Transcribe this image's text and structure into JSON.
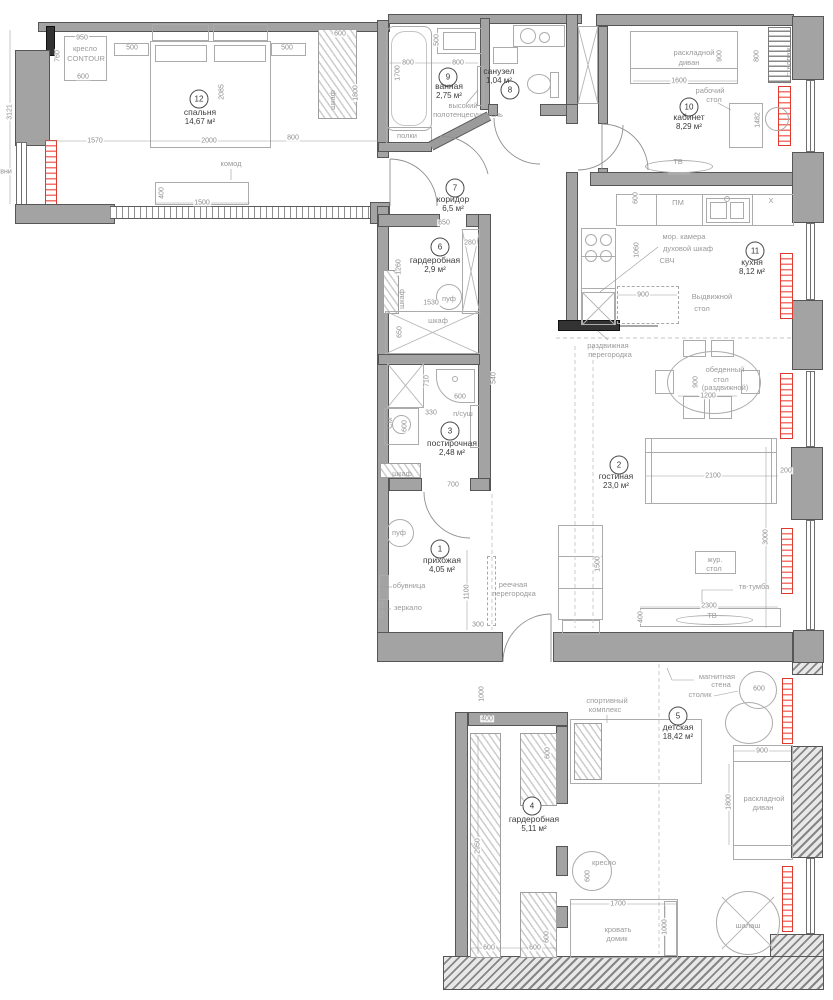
{
  "colors": {
    "wall": "#a3a3a3",
    "wall_dark": "#3f3f3f",
    "radiator": "#e03a2f",
    "dim_text": "#8e8e8e",
    "furniture_text": "#9a9a9a",
    "room_text": "#3c3c3c"
  },
  "rooms": [
    {
      "num": "1",
      "name": "прихожая",
      "area": "4,05 м²",
      "cx": 440,
      "cy": 549,
      "tx": 442,
      "ty": 565
    },
    {
      "num": "2",
      "name": "гостиная",
      "area": "23,0 м²",
      "cx": 619,
      "cy": 465,
      "tx": 616,
      "ty": 481
    },
    {
      "num": "3",
      "name": "постирочная",
      "area": "2,48 м²",
      "cx": 450,
      "cy": 431,
      "tx": 452,
      "ty": 448
    },
    {
      "num": "4",
      "name": "гардеробная",
      "area": "5,11 м²",
      "cx": 532,
      "cy": 806,
      "tx": 534,
      "ty": 824
    },
    {
      "num": "5",
      "name": "детская",
      "area": "18,42 м²",
      "cx": 678,
      "cy": 716,
      "tx": 678,
      "ty": 732
    },
    {
      "num": "6",
      "name": "гардеробная",
      "area": "2,9 м²",
      "cx": 440,
      "cy": 247,
      "tx": 435,
      "ty": 265
    },
    {
      "num": "7",
      "name": "коридор",
      "area": "6,5 м²",
      "cx": 455,
      "cy": 188,
      "tx": 453,
      "ty": 204
    },
    {
      "num": "8",
      "name": "санузел",
      "area": "1,04 м²",
      "cx": 510,
      "cy": 90,
      "tx": 499,
      "ty": 76
    },
    {
      "num": "9",
      "name": "ванная",
      "area": "2,75 м²",
      "cx": 448,
      "cy": 77,
      "tx": 449,
      "ty": 91
    },
    {
      "num": "10",
      "name": "кабинет",
      "area": "8,29 м²",
      "cx": 689,
      "cy": 107,
      "tx": 689,
      "ty": 122
    },
    {
      "num": "11",
      "name": "кухня",
      "area": "8,12 м²",
      "cx": 755,
      "cy": 251,
      "tx": 752,
      "ty": 267
    },
    {
      "num": "12",
      "name": "спальня",
      "area": "14,67 м²",
      "cx": 199,
      "cy": 99,
      "tx": 200,
      "ty": 117
    }
  ],
  "labels": [
    {
      "t": "950",
      "x": 82,
      "y": 38,
      "v": 0,
      "k": "d"
    },
    {
      "t": "500",
      "x": 132,
      "y": 48,
      "v": 0,
      "k": "d"
    },
    {
      "t": "500",
      "x": 287,
      "y": 48,
      "v": 0,
      "k": "d"
    },
    {
      "t": "600",
      "x": 340,
      "y": 34,
      "v": 0,
      "k": "d"
    },
    {
      "t": "760",
      "x": 58,
      "y": 56,
      "v": 1,
      "k": "d"
    },
    {
      "t": "кресло",
      "x": 85,
      "y": 49,
      "v": 0,
      "k": "f"
    },
    {
      "t": "CONTOUR",
      "x": 86,
      "y": 59,
      "v": 0,
      "k": "f"
    },
    {
      "t": "600",
      "x": 83,
      "y": 77,
      "v": 0,
      "k": "d"
    },
    {
      "t": "2085",
      "x": 222,
      "y": 92,
      "v": 1,
      "k": "d"
    },
    {
      "t": "1800",
      "x": 356,
      "y": 93,
      "v": 1,
      "k": "d"
    },
    {
      "t": "шкаф",
      "x": 333,
      "y": 100,
      "v": 1,
      "k": "f"
    },
    {
      "t": "1570",
      "x": 95,
      "y": 141,
      "v": 0,
      "k": "d"
    },
    {
      "t": "2000",
      "x": 209,
      "y": 141,
      "v": 0,
      "k": "d"
    },
    {
      "t": "800",
      "x": 293,
      "y": 138,
      "v": 0,
      "k": "d"
    },
    {
      "t": "комод",
      "x": 231,
      "y": 164,
      "v": 0,
      "k": "f"
    },
    {
      "t": "400",
      "x": 162,
      "y": 193,
      "v": 1,
      "k": "d"
    },
    {
      "t": "1500",
      "x": 202,
      "y": 203,
      "v": 0,
      "k": "d"
    },
    {
      "t": "3121",
      "x": 10,
      "y": 112,
      "v": 1,
      "k": "d"
    },
    {
      "t": "вни",
      "x": 6,
      "y": 172,
      "v": 0,
      "k": "d"
    },
    {
      "t": "500",
      "x": 437,
      "y": 40,
      "v": 1,
      "k": "d"
    },
    {
      "t": "800",
      "x": 408,
      "y": 63,
      "v": 0,
      "k": "d"
    },
    {
      "t": "800",
      "x": 458,
      "y": 63,
      "v": 0,
      "k": "d"
    },
    {
      "t": "1700",
      "x": 398,
      "y": 73,
      "v": 1,
      "k": "d"
    },
    {
      "t": "высокий",
      "x": 463,
      "y": 106,
      "v": 0,
      "k": "f"
    },
    {
      "t": "полотенцесушитель",
      "x": 468,
      "y": 115,
      "v": 0,
      "k": "f"
    },
    {
      "t": "полки",
      "x": 407,
      "y": 136,
      "v": 0,
      "k": "f"
    },
    {
      "t": "900",
      "x": 720,
      "y": 56,
      "v": 1,
      "k": "d"
    },
    {
      "t": "800",
      "x": 757,
      "y": 56,
      "v": 1,
      "k": "d"
    },
    {
      "t": "раскладной",
      "x": 694,
      "y": 53,
      "v": 0,
      "k": "f"
    },
    {
      "t": "диван",
      "x": 689,
      "y": 63,
      "v": 0,
      "k": "f"
    },
    {
      "t": "1600",
      "x": 679,
      "y": 81,
      "v": 0,
      "k": "d"
    },
    {
      "t": "рабочий",
      "x": 710,
      "y": 91,
      "v": 0,
      "k": "f"
    },
    {
      "t": "стол",
      "x": 714,
      "y": 100,
      "v": 0,
      "k": "f"
    },
    {
      "t": "стеллаж",
      "x": 789,
      "y": 62,
      "v": 1,
      "k": "f"
    },
    {
      "t": "1482",
      "x": 758,
      "y": 120,
      "v": 1,
      "k": "d"
    },
    {
      "t": "ТВ",
      "x": 678,
      "y": 162,
      "v": 0,
      "k": "f"
    },
    {
      "t": "600",
      "x": 636,
      "y": 198,
      "v": 1,
      "k": "d"
    },
    {
      "t": "ПМ",
      "x": 678,
      "y": 203,
      "v": 0,
      "k": "f"
    },
    {
      "t": "Х",
      "x": 771,
      "y": 201,
      "v": 0,
      "k": "f"
    },
    {
      "t": "мор. камера",
      "x": 684,
      "y": 237,
      "v": 0,
      "k": "f"
    },
    {
      "t": "духовой шкаф",
      "x": 688,
      "y": 249,
      "v": 0,
      "k": "f"
    },
    {
      "t": "СВЧ",
      "x": 667,
      "y": 261,
      "v": 0,
      "k": "f"
    },
    {
      "t": "1060",
      "x": 637,
      "y": 250,
      "v": 1,
      "k": "d"
    },
    {
      "t": "900",
      "x": 643,
      "y": 295,
      "v": 0,
      "k": "d"
    },
    {
      "t": "Выдвижной",
      "x": 712,
      "y": 297,
      "v": 0,
      "k": "f"
    },
    {
      "t": "стол",
      "x": 702,
      "y": 309,
      "v": 0,
      "k": "f"
    },
    {
      "t": "раздвижная",
      "x": 608,
      "y": 346,
      "v": 0,
      "k": "f"
    },
    {
      "t": "перегородка",
      "x": 610,
      "y": 355,
      "v": 0,
      "k": "f"
    },
    {
      "t": "650",
      "x": 444,
      "y": 223,
      "v": 0,
      "k": "d"
    },
    {
      "t": "280",
      "x": 470,
      "y": 243,
      "v": 0,
      "k": "d"
    },
    {
      "t": "1260",
      "x": 399,
      "y": 267,
      "v": 1,
      "k": "d"
    },
    {
      "t": "шкаф",
      "x": 402,
      "y": 299,
      "v": 1,
      "k": "f"
    },
    {
      "t": "1530",
      "x": 431,
      "y": 303,
      "v": 0,
      "k": "d"
    },
    {
      "t": "пуф",
      "x": 449,
      "y": 299,
      "v": 0,
      "k": "f"
    },
    {
      "t": "шкаф",
      "x": 438,
      "y": 321,
      "v": 0,
      "k": "f"
    },
    {
      "t": "650",
      "x": 400,
      "y": 332,
      "v": 1,
      "k": "d"
    },
    {
      "t": "710",
      "x": 427,
      "y": 381,
      "v": 1,
      "k": "d"
    },
    {
      "t": "540",
      "x": 494,
      "y": 378,
      "v": 1,
      "k": "d"
    },
    {
      "t": "600",
      "x": 460,
      "y": 397,
      "v": 0,
      "k": "d"
    },
    {
      "t": "330",
      "x": 431,
      "y": 413,
      "v": 0,
      "k": "d"
    },
    {
      "t": "п/суш",
      "x": 463,
      "y": 414,
      "v": 0,
      "k": "f"
    },
    {
      "t": "СМ",
      "x": 390,
      "y": 423,
      "v": 1,
      "k": "f"
    },
    {
      "t": "600",
      "x": 405,
      "y": 426,
      "v": 1,
      "k": "d"
    },
    {
      "t": "обеденный",
      "x": 725,
      "y": 370,
      "v": 0,
      "k": "f"
    },
    {
      "t": "стол",
      "x": 721,
      "y": 380,
      "v": 0,
      "k": "f"
    },
    {
      "t": "(раздвижной)",
      "x": 725,
      "y": 388,
      "v": 0,
      "k": "f"
    },
    {
      "t": "1200",
      "x": 708,
      "y": 396,
      "v": 0,
      "k": "d"
    },
    {
      "t": "900",
      "x": 696,
      "y": 382,
      "v": 1,
      "k": "d"
    },
    {
      "t": "2100",
      "x": 713,
      "y": 476,
      "v": 0,
      "k": "d"
    },
    {
      "t": "200",
      "x": 786,
      "y": 471,
      "v": 0,
      "k": "d"
    },
    {
      "t": "1500",
      "x": 598,
      "y": 564,
      "v": 1,
      "k": "d"
    },
    {
      "t": "жур.",
      "x": 715,
      "y": 560,
      "v": 0,
      "k": "f"
    },
    {
      "t": "стол",
      "x": 714,
      "y": 569,
      "v": 0,
      "k": "f"
    },
    {
      "t": "тв-тумба",
      "x": 754,
      "y": 587,
      "v": 0,
      "k": "f"
    },
    {
      "t": "2300",
      "x": 709,
      "y": 606,
      "v": 0,
      "k": "d"
    },
    {
      "t": "ТВ",
      "x": 712,
      "y": 616,
      "v": 0,
      "k": "f"
    },
    {
      "t": "400",
      "x": 641,
      "y": 617,
      "v": 1,
      "k": "d"
    },
    {
      "t": "3000",
      "x": 766,
      "y": 537,
      "v": 1,
      "k": "d"
    },
    {
      "t": "шкаф",
      "x": 402,
      "y": 474,
      "v": 0,
      "k": "f"
    },
    {
      "t": "700",
      "x": 453,
      "y": 485,
      "v": 0,
      "k": "d"
    },
    {
      "t": "пуф",
      "x": 399,
      "y": 533,
      "v": 0,
      "k": "f"
    },
    {
      "t": "обувница",
      "x": 409,
      "y": 586,
      "v": 0,
      "k": "f"
    },
    {
      "t": "зеркало",
      "x": 408,
      "y": 608,
      "v": 0,
      "k": "f"
    },
    {
      "t": "1100",
      "x": 467,
      "y": 592,
      "v": 1,
      "k": "d"
    },
    {
      "t": "300",
      "x": 478,
      "y": 625,
      "v": 0,
      "k": "d"
    },
    {
      "t": "реечная",
      "x": 513,
      "y": 585,
      "v": 0,
      "k": "f"
    },
    {
      "t": "перегородка",
      "x": 514,
      "y": 594,
      "v": 0,
      "k": "f"
    },
    {
      "t": "магнитная",
      "x": 717,
      "y": 677,
      "v": 0,
      "k": "f"
    },
    {
      "t": "стена",
      "x": 721,
      "y": 685,
      "v": 0,
      "k": "f"
    },
    {
      "t": "столик",
      "x": 700,
      "y": 695,
      "v": 0,
      "k": "f"
    },
    {
      "t": "600",
      "x": 759,
      "y": 689,
      "v": 0,
      "k": "d"
    },
    {
      "t": "спортивный",
      "x": 607,
      "y": 701,
      "v": 0,
      "k": "f"
    },
    {
      "t": "комплекс",
      "x": 605,
      "y": 710,
      "v": 0,
      "k": "f"
    },
    {
      "t": "1000",
      "x": 482,
      "y": 694,
      "v": 1,
      "k": "d"
    },
    {
      "t": "400",
      "x": 487,
      "y": 719,
      "v": 0,
      "k": "d"
    },
    {
      "t": "600",
      "x": 548,
      "y": 753,
      "v": 1,
      "k": "d"
    },
    {
      "t": "2950",
      "x": 478,
      "y": 846,
      "v": 1,
      "k": "d"
    },
    {
      "t": "кресло",
      "x": 604,
      "y": 863,
      "v": 0,
      "k": "f"
    },
    {
      "t": "600",
      "x": 588,
      "y": 876,
      "v": 1,
      "k": "d"
    },
    {
      "t": "900",
      "x": 762,
      "y": 751,
      "v": 0,
      "k": "d"
    },
    {
      "t": "раскладной",
      "x": 764,
      "y": 799,
      "v": 0,
      "k": "f"
    },
    {
      "t": "диван",
      "x": 763,
      "y": 808,
      "v": 0,
      "k": "f"
    },
    {
      "t": "1800",
      "x": 729,
      "y": 802,
      "v": 1,
      "k": "d"
    },
    {
      "t": "1700",
      "x": 618,
      "y": 904,
      "v": 0,
      "k": "d"
    },
    {
      "t": "кровать",
      "x": 618,
      "y": 930,
      "v": 0,
      "k": "f"
    },
    {
      "t": "домик",
      "x": 617,
      "y": 939,
      "v": 0,
      "k": "f"
    },
    {
      "t": "1000",
      "x": 665,
      "y": 927,
      "v": 1,
      "k": "d"
    },
    {
      "t": "шалаш",
      "x": 748,
      "y": 926,
      "v": 0,
      "k": "f"
    },
    {
      "t": "600",
      "x": 489,
      "y": 948,
      "v": 0,
      "k": "d"
    },
    {
      "t": "600",
      "x": 535,
      "y": 948,
      "v": 0,
      "k": "d"
    },
    {
      "t": "600",
      "x": 547,
      "y": 937,
      "v": 1,
      "k": "d"
    }
  ]
}
